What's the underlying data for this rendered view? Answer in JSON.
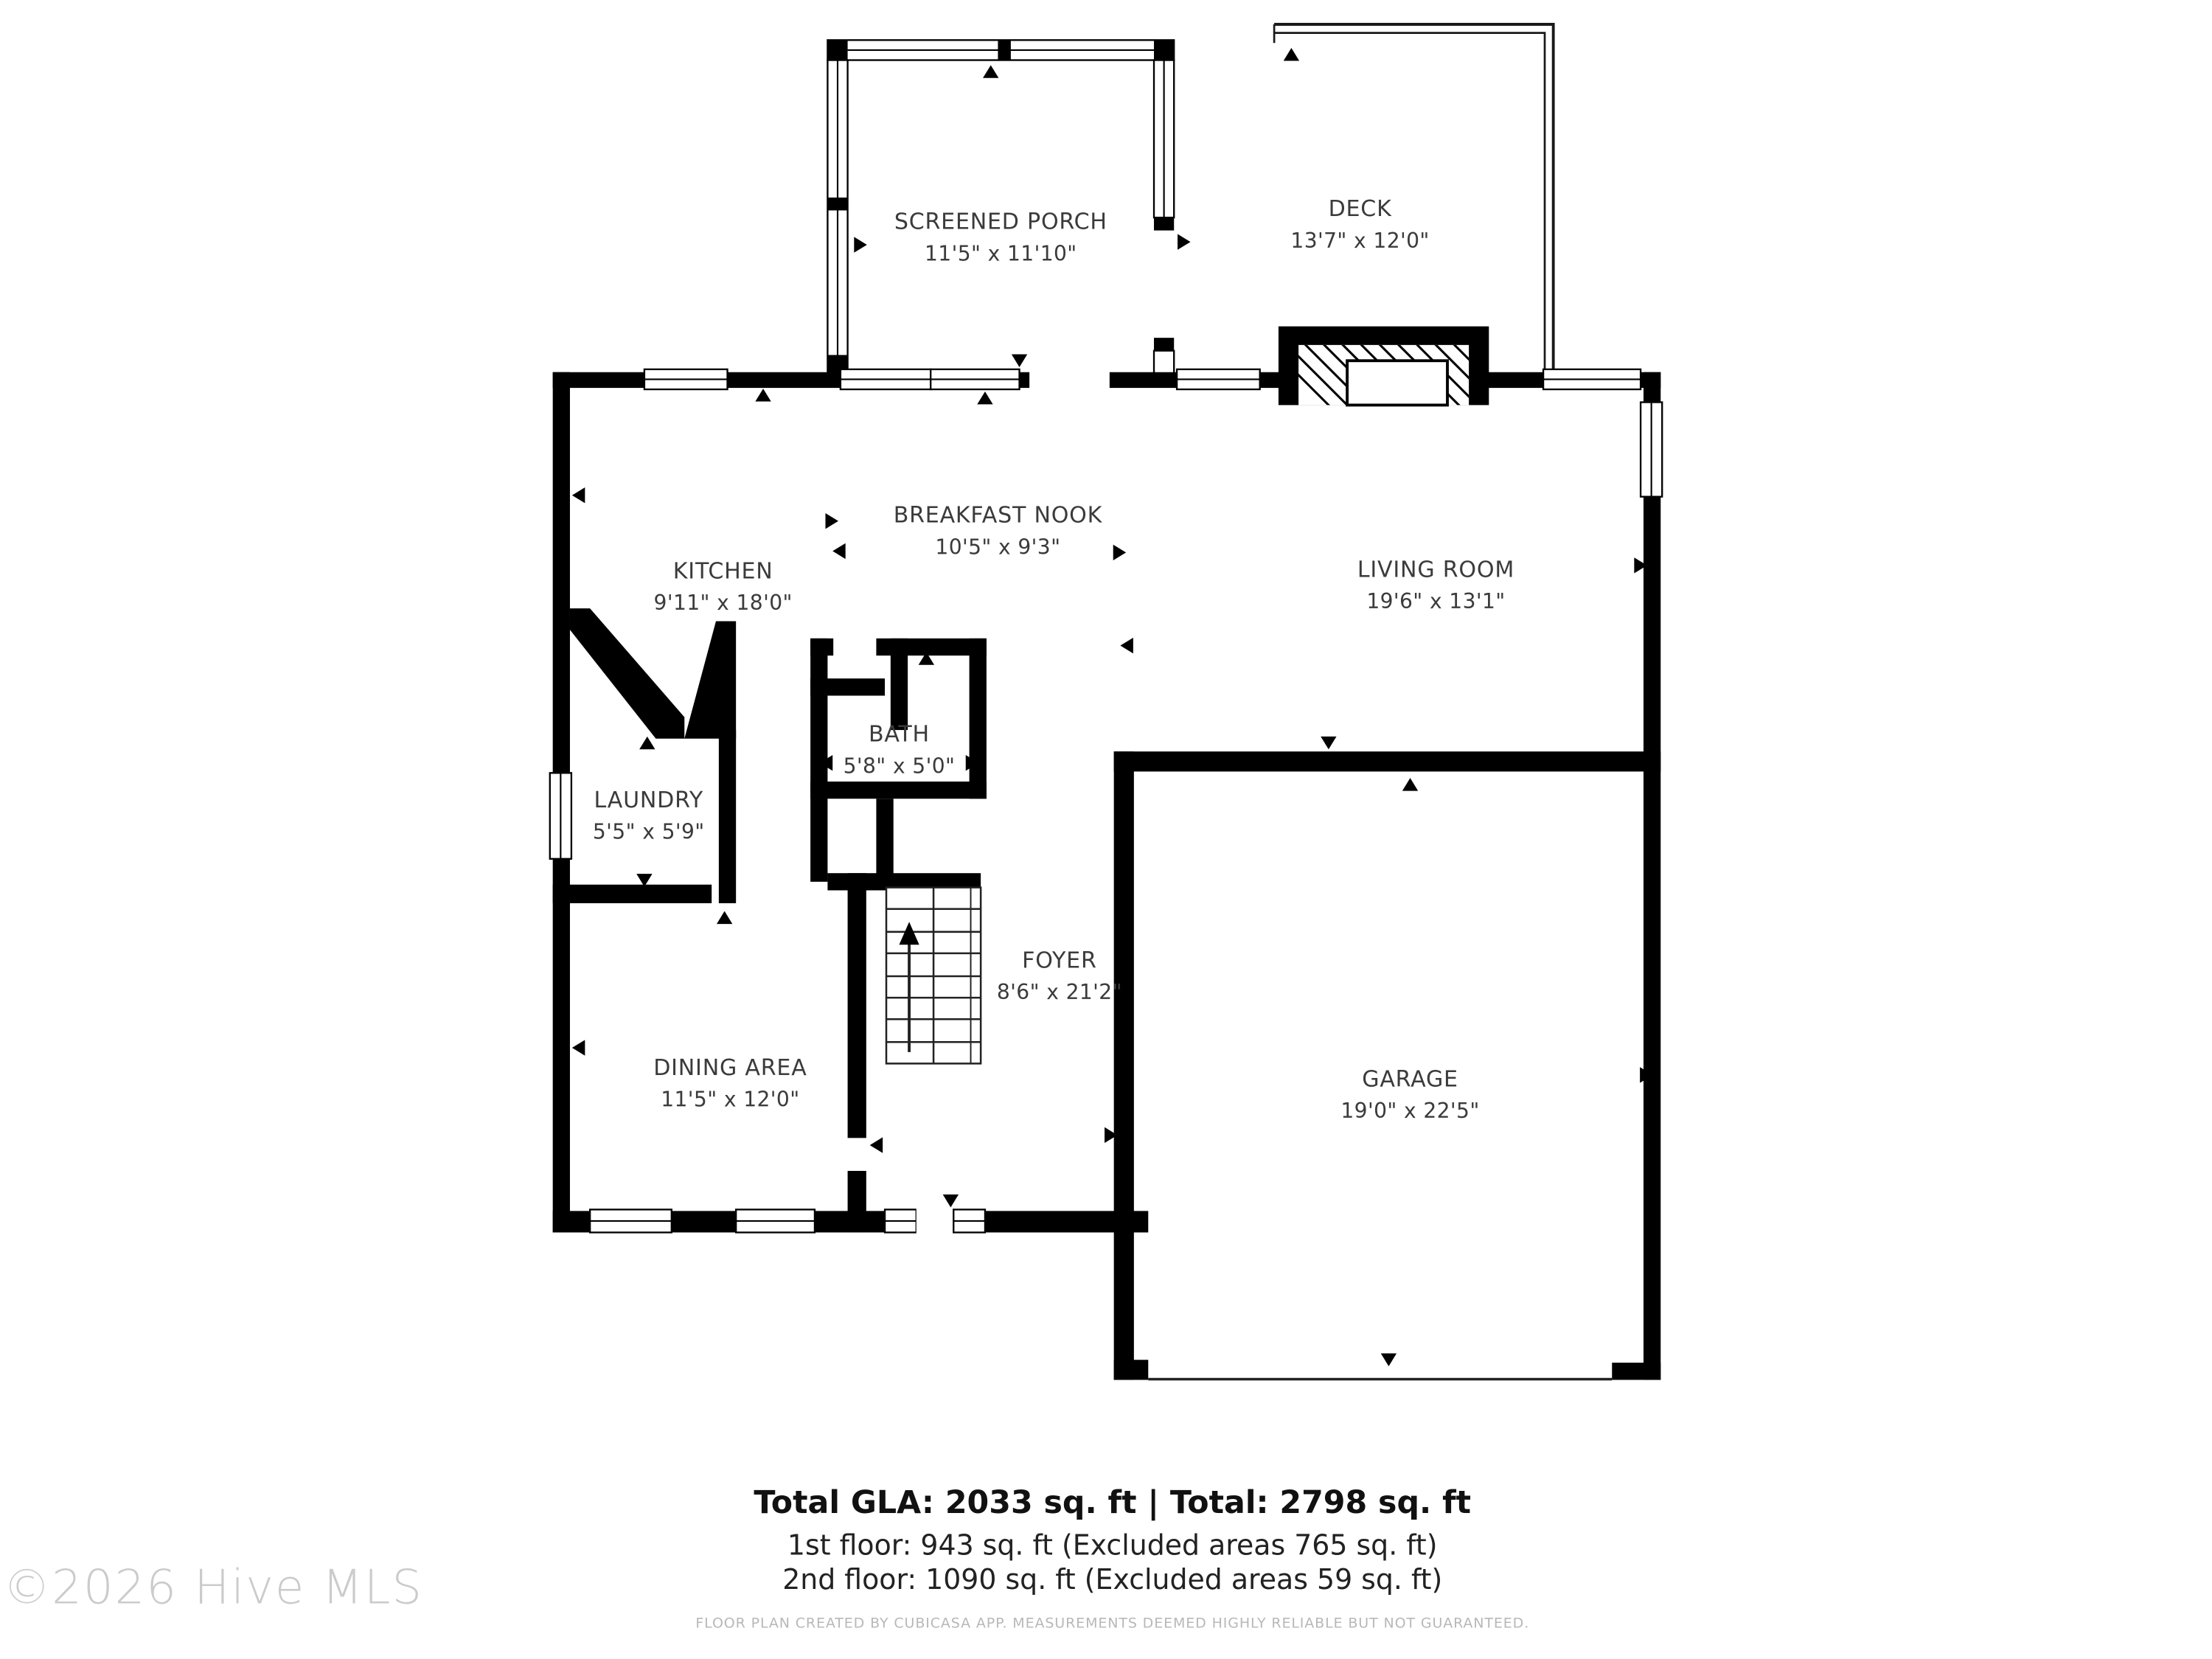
{
  "floor_plan": {
    "rooms": [
      {
        "name": "SCREENED PORCH",
        "dims": "11'5\" x 11'10\""
      },
      {
        "name": "DECK",
        "dims": "13'7\" x 12'0\""
      },
      {
        "name": "BREAKFAST NOOK",
        "dims": "10'5\" x 9'3\""
      },
      {
        "name": "KITCHEN",
        "dims": "9'11\" x 18'0\""
      },
      {
        "name": "LIVING ROOM",
        "dims": "19'6\" x 13'1\""
      },
      {
        "name": "BATH",
        "dims": "5'8\" x 5'0\""
      },
      {
        "name": "LAUNDRY",
        "dims": "5'5\" x 5'9\""
      },
      {
        "name": "FOYER",
        "dims": "8'6\" x 21'2\""
      },
      {
        "name": "DINING AREA",
        "dims": "11'5\" x 12'0\""
      },
      {
        "name": "GARAGE",
        "dims": "19'0\" x 22'5\""
      }
    ],
    "summary": {
      "total_line": "Total GLA: 2033 sq. ft | Total: 2798 sq. ft",
      "first_floor_line": "1st floor: 943 sq. ft (Excluded areas 765 sq. ft)",
      "second_floor_line": "2nd floor: 1090 sq. ft (Excluded areas 59 sq. ft)"
    },
    "footer": "FLOOR PLAN CREATED BY CUBICASA APP. MEASUREMENTS DEEMED HIGHLY RELIABLE BUT NOT GUARANTEED.",
    "watermark": "©2026 Hive MLS",
    "colors": {
      "wall": "#000000",
      "background": "#ffffff",
      "label_text": "#3b3b3b",
      "summary_text": "#111111",
      "footer_text": "#b8b8b8",
      "watermark_text": "#cbcbcb"
    }
  }
}
